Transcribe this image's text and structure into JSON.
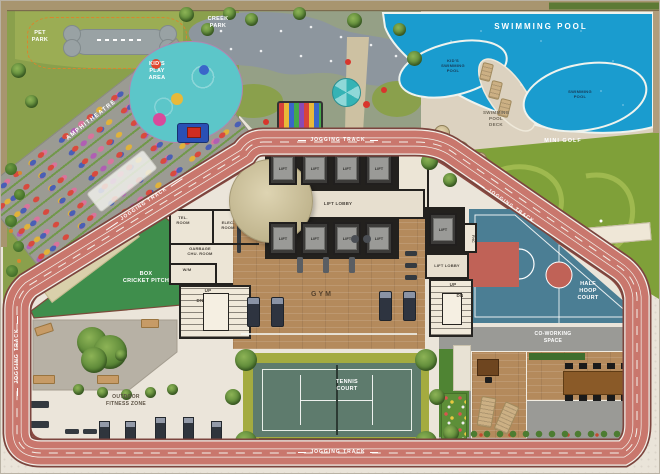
{
  "plan": {
    "zones": {
      "pet_park": "PET PARK",
      "creek_park": "CREEK PARK",
      "kids_play_area": "KID'S PLAY AREA",
      "amphitheatre": "AMPHITHEATRE",
      "swimming_pool": "SWIMMING POOL",
      "kids_swimming_pool": "KID'S SWIMMING POOL",
      "swimming_pool_small": "SWIMMING POOL",
      "swimming_pool_deck": "SWIMMING POOL DECK",
      "mini_golf": "MINI GOLF",
      "jogging_track": "JOGGING TRACK",
      "box_cricket_pitch": "BOX\nCRICKET PITCH",
      "gym": "GYM",
      "tennis_court": "TENNIS COURT",
      "half_hoop_court": "HALF HOOP COURT",
      "co_working_space": "CO-WORKING SPACE",
      "outdoor_fitness_zone": "OUTDOOR FITNESS ZONE"
    },
    "rooms": {
      "lift": "LIFT",
      "lift_lobby": "LIFT LOBBY",
      "tel_room": "TEL. ROOM",
      "elec_room": "ELEC. ROOM",
      "garbage_chute_room": "GARBAGE CHU. ROOM",
      "washing_machine": "W/M",
      "fhc": "FHC",
      "up": "UP",
      "dn": "DN"
    },
    "colors": {
      "track": "#c9776d",
      "pool_water": "#1a9ccf",
      "court_blue": "#4b7e94",
      "court_red": "#c06257",
      "cricket_green": "#3f8e4c",
      "tennis_green": "#5e7b6d",
      "wood_floor": "#b48a5c",
      "paving": "#eae4d9"
    }
  }
}
